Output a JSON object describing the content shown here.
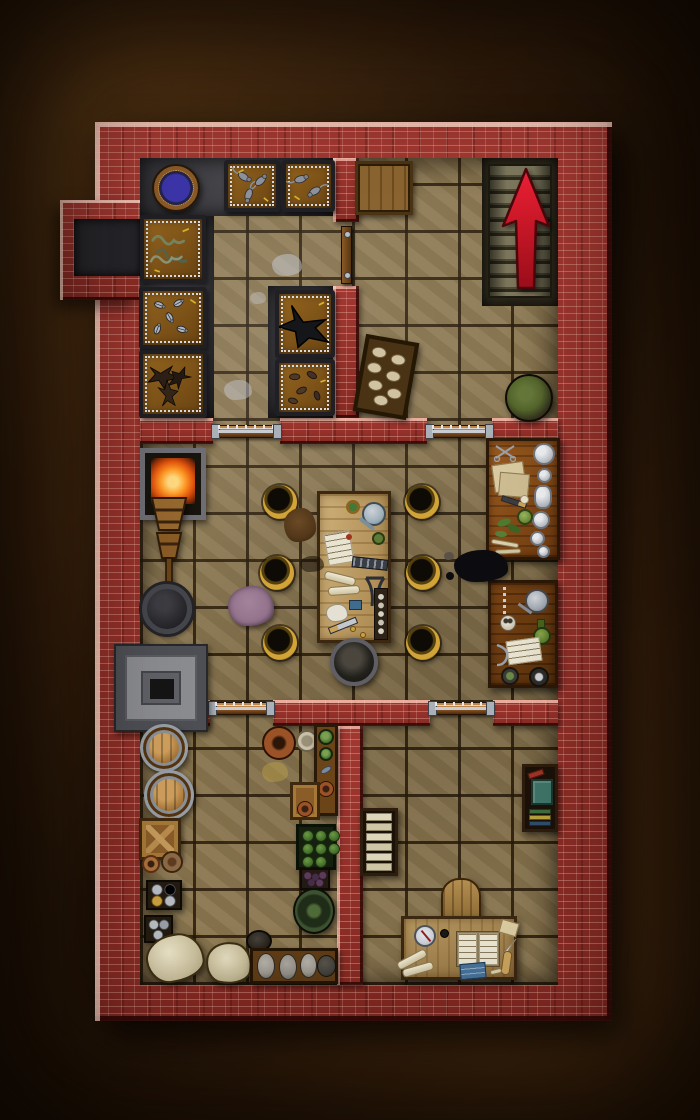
{
  "scene": {
    "kind": "top-down dungeon battle map, red brick walls",
    "label": "Brick-walled basement map with five rooms",
    "exit_arrow": {
      "glyph": "up-arrow",
      "color": "#d8142a",
      "direction": "up",
      "over": "staircase"
    }
  },
  "palette": {
    "background_dirt": "#472a10",
    "brick": "#8f2d26",
    "brick_highlight": "#f2cabc",
    "brick_shadow": "#300805",
    "stone_floor": "#8b7750",
    "grout": "#32230f",
    "dark_floor": "#38383d",
    "wood_light": "#cdb079",
    "wood_mid": "#8a5a1d",
    "wood_dark": "#5e3a14",
    "metal": "#9aa0a8",
    "arrow_red": "#d8142a",
    "brazier_gold": "#d2a437",
    "fire_orange": "#ff9c28",
    "moss_green": "#55662c",
    "ritual_blue": "#3c35a8"
  },
  "rooms": {
    "pen": {
      "label": "Creature pen: dark floor with stacked animal cages and blue ritual disc",
      "floor": "dark"
    },
    "stairhall": {
      "label": "Entry hall: staircase up marked with red arrow, wooden trapdoor, tray of loaves, moss basket",
      "floor": "stone"
    },
    "workshop": {
      "label": "Workshop: forge, bellows, coal grate, stone oven, tool table ringed by six gold braziers, cauldron, two alchemy benches",
      "floor": "stone"
    },
    "store": {
      "label": "Storeroom: barrels, crate, jar boxes, grain sacks, shelf of bowls, cabbage crate, berry box, trough of sacks",
      "floor": "stone"
    },
    "study": {
      "label": "Study: bookshelves, chair and writing desk with open book, compass and scrolls",
      "floor": "stone"
    }
  },
  "inventory": {
    "pen": [
      "blue ritual disc",
      "cage of rats",
      "cage of rats",
      "cage of snakes",
      "cage of beetles",
      "cage of dark birds",
      "cage with raven",
      "cage of mice",
      "grey splatter stains"
    ],
    "stairhall": [
      "wooden trapdoor",
      "staircase up with red arrow",
      "tray of loaves",
      "basket of green moss"
    ],
    "workshop": [
      "forge fire",
      "wooden bellows",
      "coal grate",
      "grey stone oven",
      "work table with tools, kettle, papers and knife",
      "six gold floor braziers",
      "iron cauldron",
      "purple rag",
      "fur scrap",
      "alchemy bench with glass jars and herbs",
      "alchemy bench with alembic, skull and scroll",
      "spilled ink"
    ],
    "store": [
      "two wooden barrels",
      "crate with cross braces",
      "small plates",
      "boxes of grey jars",
      "white grain sacks",
      "red clay pot",
      "shelf with green bowls and fish",
      "crate of cabbages",
      "box of dark berries",
      "green dish",
      "dark pot",
      "trough with grey sacks"
    ],
    "study": [
      "shelf of pale books",
      "bookshelf with teal tome and coloured books",
      "wooden chair",
      "writing desk",
      "open book",
      "compass",
      "scroll rolls",
      "blue chart",
      "quill and papers"
    ]
  },
  "doors": {
    "count": 5,
    "style": "barred wooden beams with iron end plates and studs"
  }
}
